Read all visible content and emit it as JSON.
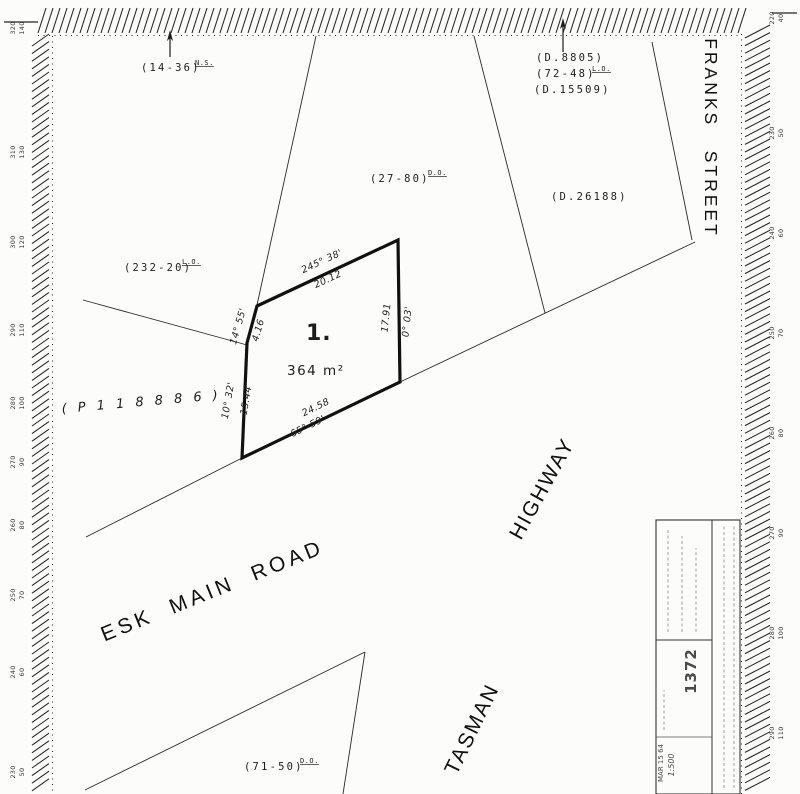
{
  "labels": {
    "ref_ns": "(14-36)",
    "ref_ns_sup": "N.S.",
    "ref_d8805": "(D.8805)",
    "ref_7248": "(72-48)",
    "ref_7248_sup": "L.O.",
    "ref_d15509": "(D.15509)",
    "ref_2780": "(27-80)",
    "ref_2780_sup": "D.O.",
    "ref_d26188": "(D.26188)",
    "ref_23220": "(232-20)",
    "ref_23220_sup": "L.O.",
    "ref_p118886": "( P 1 1 8 8 8 6 )",
    "ref_7150": "(71-50)",
    "ref_7150_sup": "D.O."
  },
  "streets": {
    "franks": "FRANKS   STREET",
    "esk": "ESK  MAIN  ROAD",
    "tasman": "TASMAN",
    "highway": "HIGHWAY"
  },
  "parcel": {
    "number": "1.",
    "area": "364 m²"
  },
  "dimensions": {
    "top_bearing": "245° 38'",
    "top_length": "20.12",
    "left_upper_bearing": "14° 55'",
    "left_upper_length": "4.16",
    "left_lower_bearing": "10° 32'",
    "left_lower_length": "15.44",
    "right_bearing": "0° 03'",
    "right_length": "17.91",
    "bottom_bearing": "65° 59'",
    "bottom_length": "24.58"
  },
  "title_block": {
    "plan_number": "1372",
    "date_stamp": "MAR 15 64",
    "scale": "1:500"
  },
  "border_scale": {
    "left": [
      [
        "320",
        "140"
      ],
      [
        "310",
        "130"
      ],
      [
        "300",
        "120"
      ],
      [
        "290",
        "110"
      ],
      [
        "280",
        "100"
      ],
      [
        "270",
        "90"
      ],
      [
        "260",
        "80"
      ],
      [
        "250",
        "70"
      ],
      [
        "240",
        "60"
      ],
      [
        "230",
        "50"
      ]
    ],
    "right": [
      [
        "220",
        "40"
      ],
      [
        "230",
        "50"
      ],
      [
        "240",
        "60"
      ],
      [
        "250",
        "70"
      ],
      [
        "260",
        "80"
      ],
      [
        "270",
        "90"
      ],
      [
        "280",
        "100"
      ],
      [
        "290",
        "110"
      ]
    ]
  }
}
